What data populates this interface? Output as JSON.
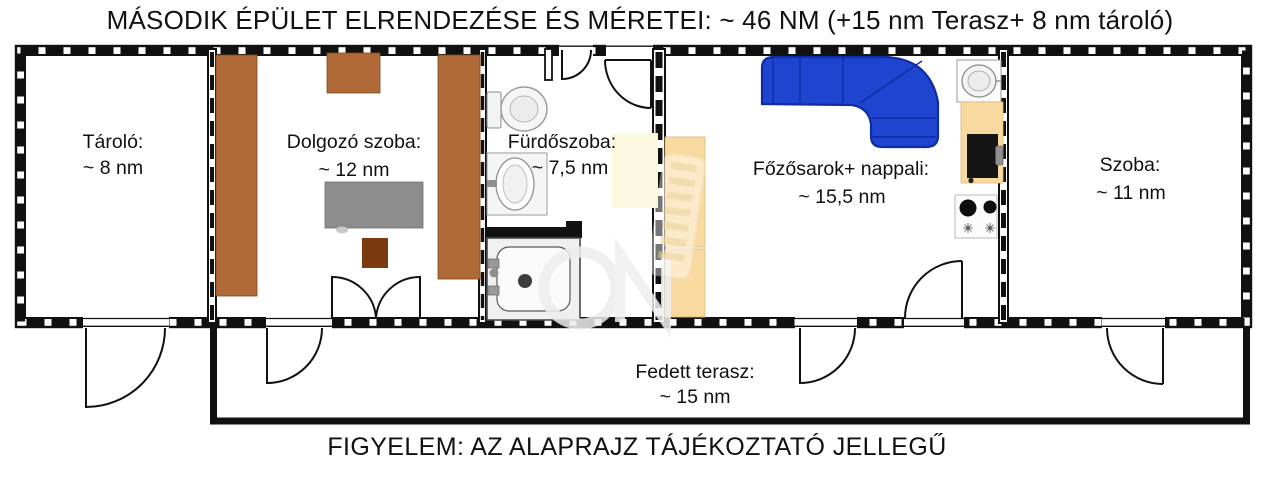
{
  "title": "MÁSODIK ÉPÜLET ELRENDEZÉSE ÉS MÉRETEI: ~ 46 NM (+15 nm Terasz+ 8 nm tároló)",
  "footer_warning": "FIGYELEM: AZ ALAPRAJZ TÁJÉKOZTATÓ JELLEGŰ",
  "rooms": {
    "tarolo": {
      "name": "Tároló:",
      "area": "~ 8 nm"
    },
    "dolgozo": {
      "name": "Dolgozó szoba:",
      "area": "~ 12 nm"
    },
    "furdoszoba": {
      "name": "Fürdőszoba:",
      "area": "~ 7,5 nm"
    },
    "fozosarok": {
      "name": "Főzősarok+ nappali:",
      "area": "~ 15,5 nm"
    },
    "szoba": {
      "name": "Szoba:",
      "area": "~ 11 nm"
    },
    "terasz": {
      "name": "Fedett terasz:",
      "area": "~ 15 nm"
    }
  },
  "colors": {
    "wall": "#111111",
    "wood_brown": "#b06a38",
    "chair_brown": "#7a3a0e",
    "desk_gray": "#8d8d8d",
    "sofa_blue": "#1e44d0",
    "sofa_line": "#0d2da0",
    "counter_tan": "#f8d9a0",
    "cream": "#fcf8e0",
    "stove_black": "#141414"
  },
  "furniture_legend": [
    "bookshelf",
    "desk",
    "chair",
    "double-door",
    "toilet",
    "washbasin",
    "shower-tray",
    "corner-sofa",
    "kitchen-counter",
    "kitchen-sink",
    "stove-oven",
    "cooktop"
  ]
}
